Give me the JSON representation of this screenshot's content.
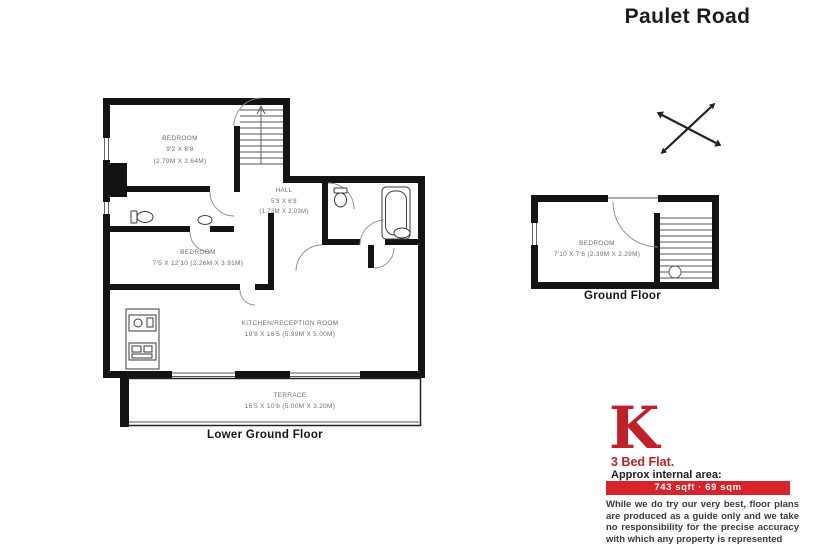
{
  "page": {
    "title": "Paulet Road"
  },
  "colors": {
    "brand_red": "#c1202a",
    "bar_red": "#d8232b",
    "wall_black": "#141414"
  },
  "icons": {
    "compass": "crossed-survey-arrows-icon",
    "stairs": "stairs-icon",
    "bath": "bathtub-icon",
    "toilet": "toilet-icon",
    "sink": "sink-icon",
    "kitchen_units": "kitchen-units-icon"
  },
  "floors": {
    "lower": {
      "label": "Lower Ground Floor",
      "rooms": {
        "bedroom1": {
          "name": "BEDROOM",
          "dims_ft": "9'2 x 8'8",
          "dims_m": "(2.79m x 2.64m)"
        },
        "hall": {
          "name": "HALL",
          "dims_ft": "5'8 x 6'8",
          "dims_m": "(1.73m x 2.03m)"
        },
        "bedroom2": {
          "name": "BEDROOM",
          "dims": "7'5 x 12'10 (2.26m x 3.91m)"
        },
        "kitchen": {
          "name": "KITCHEN/RECEPTION ROOM",
          "dims": "19'8 x 16'5 (5.99m x 5.00m)"
        },
        "terrace": {
          "name": "TERRACE",
          "dims": "16'5 x 10'6 (5.00m x 3.20m)"
        }
      }
    },
    "ground": {
      "label": "Ground Floor",
      "rooms": {
        "bedroom": {
          "name": "BEDROOM",
          "dims": "7'10 x 7'6 (2.39m x 2.29m)"
        }
      }
    }
  },
  "branding": {
    "logo_letter": "K",
    "property_type": "3 Bed Flat.",
    "area_heading": "Approx internal area:",
    "area_value": "743 sqft · 69 sqm",
    "disclaimer": "While we do try our very best, floor plans are produced as a guide only and we take no responsibility for the precise accuracy with which any property is represented"
  }
}
